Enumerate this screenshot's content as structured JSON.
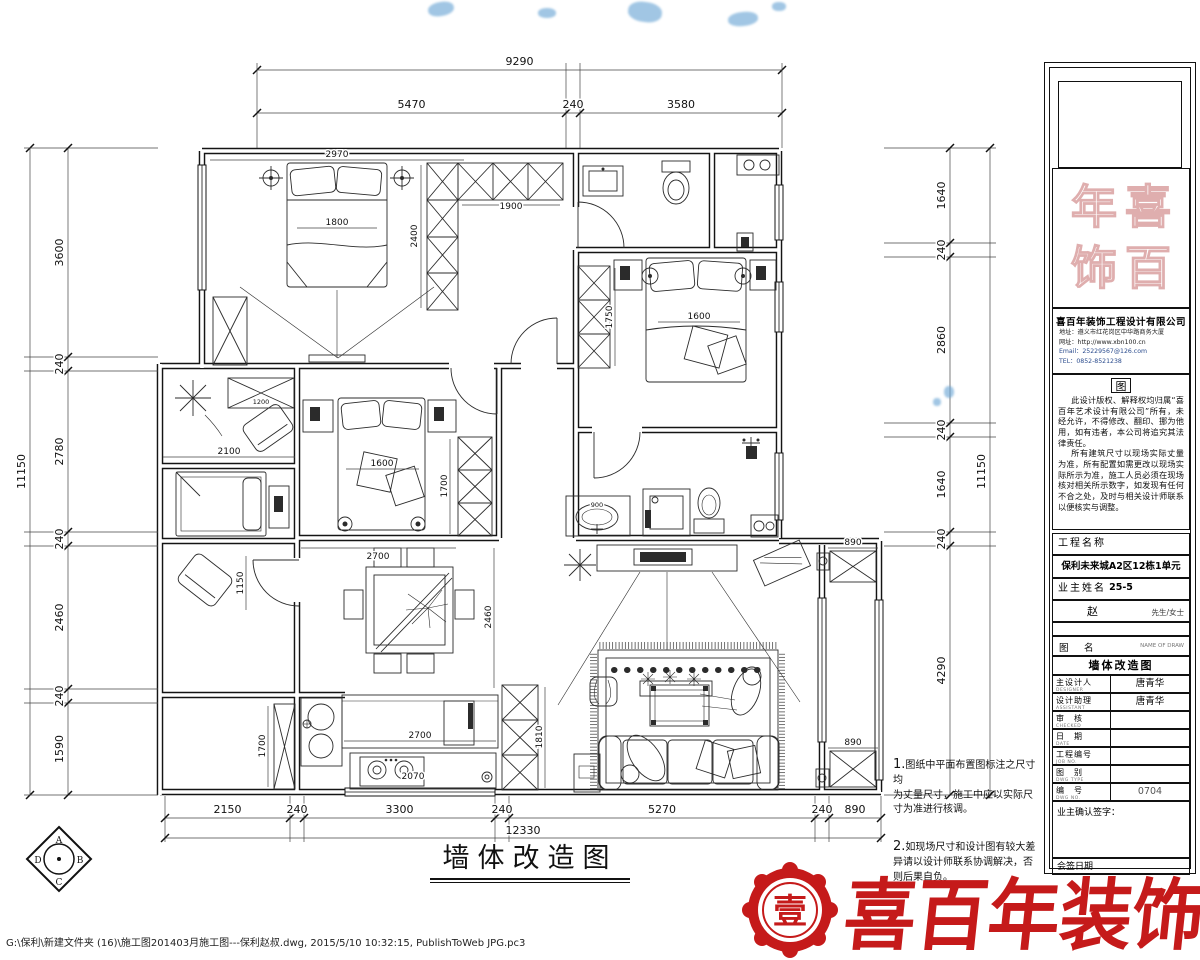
{
  "page": {
    "file_path": "G:\\保利\\新建文件夹 (16)\\施工图201403月施工图---保利赵叔.dwg, 2015/5/10 10:32:15, PublishToWeb JPG.pc3"
  },
  "plan": {
    "title": "墙体改造图",
    "dims": {
      "top_overall": "9290",
      "top_chain": [
        "5470",
        "240",
        "3580"
      ],
      "left_overall": "11150",
      "left_chain": [
        "3600",
        "240",
        "2780",
        "240",
        "2460",
        "240",
        "1590"
      ],
      "right_chain": [
        "1640",
        "240",
        "2860",
        "240",
        "1640",
        "240",
        "4290"
      ],
      "right_overall": "11150",
      "bottom_chain": [
        "2150",
        "240",
        "3300",
        "240",
        "5270",
        "240",
        "890"
      ],
      "bottom_overall": "12330"
    },
    "labels": {
      "bedroom1_width": "2970",
      "bed1_width": "1800",
      "wardrobe1_width": "1900",
      "wardrobe1_depth": "2400",
      "bench": "1200",
      "room_left_width": "2100",
      "bed2_width": "1600",
      "wardrobe2_height": "1750",
      "bed3_width": "1600",
      "bedroom3_width": "2700",
      "wardrobe3_height": "1700",
      "hall_width": "1150",
      "dining_height": "2460",
      "counter_width": "2700",
      "stove_width": "2070",
      "cabinet_kitchen": "1810",
      "cabinet_left": "1700",
      "balcony_cabinet_top": "890",
      "balcony_cabinet_bottom": "890",
      "basin": "900"
    }
  },
  "notes": {
    "n1_num": "1.",
    "n1_lines": [
      "图纸中平面布置图标注之尺寸均",
      "为丈量尺寸，施工中应以实际尺",
      "寸为准进行核调。"
    ],
    "n2_num": "2.",
    "n2_lines": [
      "如现场尺寸和设计图有较大差",
      "异请以设计师联系协调解决，否",
      "则后果自负。"
    ]
  },
  "titleblock": {
    "seal_chars": [
      "年",
      "喜",
      "饰",
      "百"
    ],
    "company": "喜百年装饰工程设计有限公司",
    "contact_address": "地址：遵义市红花岗区中华路商务大厦",
    "contact_web": "网址：http://www.xbn100.cn",
    "contact_email": "Email：25229567@126.com",
    "contact_tel": "TEL：0852-8521238",
    "notice_title": "图",
    "notice_p1": "此设计版权、解释权均归属“喜百年艺术设计有限公司”所有，未经允许，不得修改、翻印、挪为他用，如有违者，本公司将追究其法律责任。",
    "notice_p2": "所有建筑尺寸以现场实际丈量为准，所有配置如需更改以现场实际所示为准，施工人员必须在现场核对相关所示数字，如发现有任何不合之处，及时与相关设计师联系以便核实与调整。",
    "project_label": "工程名称",
    "project_name": "保利未来城A2区12栋1单元25-5",
    "owner_label": "业主姓名",
    "owner_name": "赵",
    "owner_suffix": "先生/女士",
    "drawing_label": "图　名",
    "drawing_label_en": "NAME OF DRAW",
    "drawing_name": "墙体改造图",
    "rows": [
      {
        "label": "主设计人",
        "sub": "DESIGNER",
        "value": "唐青华"
      },
      {
        "label": "设计助理",
        "sub": "ASSISTANT",
        "value": "唐青华"
      },
      {
        "label": "审　核",
        "sub": "CHECKED",
        "value": ""
      },
      {
        "label": "日　期",
        "sub": "DATE",
        "value": ""
      },
      {
        "label": "工程编号",
        "sub": "JOB NO.",
        "value": ""
      },
      {
        "label": "图　别",
        "sub": "DWG TYPE",
        "value": ""
      },
      {
        "label": "编　号",
        "sub": "DWG NO.",
        "value": "0704"
      }
    ],
    "sign_label": "业主确认签字：",
    "countersign_label": "会签日期"
  },
  "stamp": {
    "seal_char": "壹",
    "brand": "喜百年装饰"
  },
  "corner": {
    "top": "A",
    "left": "D",
    "right": "B",
    "bottom": "C"
  }
}
